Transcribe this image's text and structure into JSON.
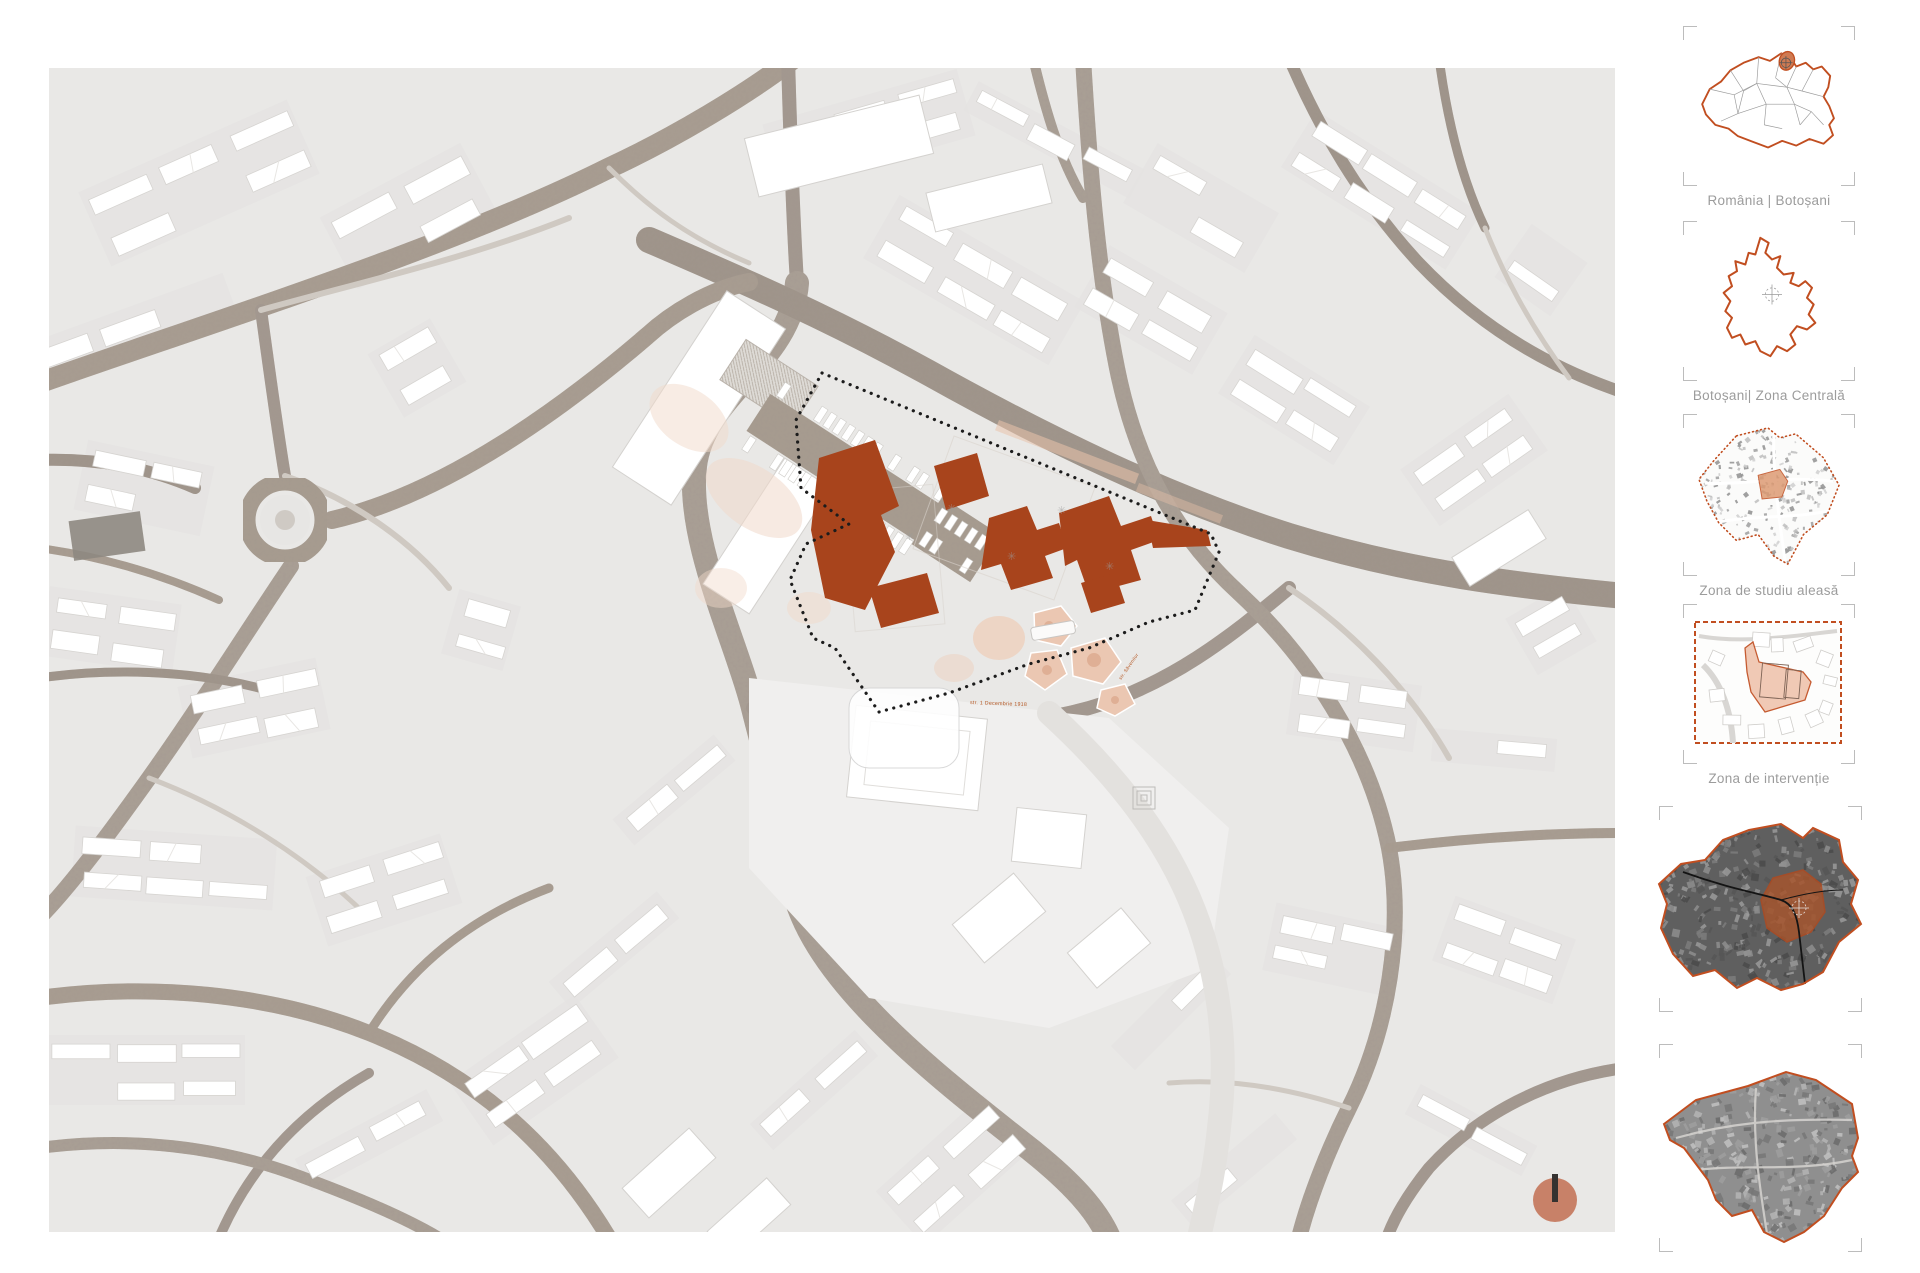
{
  "sidebar": {
    "items": [
      {
        "id": "romania",
        "label": "România | Botoșani"
      },
      {
        "id": "county",
        "label": "Botoșani| Zona Centrală"
      },
      {
        "id": "study-zone",
        "label": "Zona de studiu aleasă"
      },
      {
        "id": "intervention",
        "label": "Zona de intervenție"
      },
      {
        "id": "satellite-central-zone",
        "label": ""
      },
      {
        "id": "satellite-study-zone",
        "label": ""
      }
    ]
  },
  "map": {
    "street_labels": [
      {
        "text": "str. 1 Decembrie 1918"
      },
      {
        "text": "str. Săvenilor"
      }
    ],
    "icons": [
      "north-arrow-icon",
      "crosshair-icon"
    ]
  },
  "colors": {
    "accent": "#c14e20",
    "zone_building": "#a8441c",
    "county_highlight": "#cf7a52",
    "plaza_pink": "#eecdb8",
    "street": "#a79c90",
    "label_gray": "#9c9c9c",
    "north_circle": "#c4755a"
  }
}
